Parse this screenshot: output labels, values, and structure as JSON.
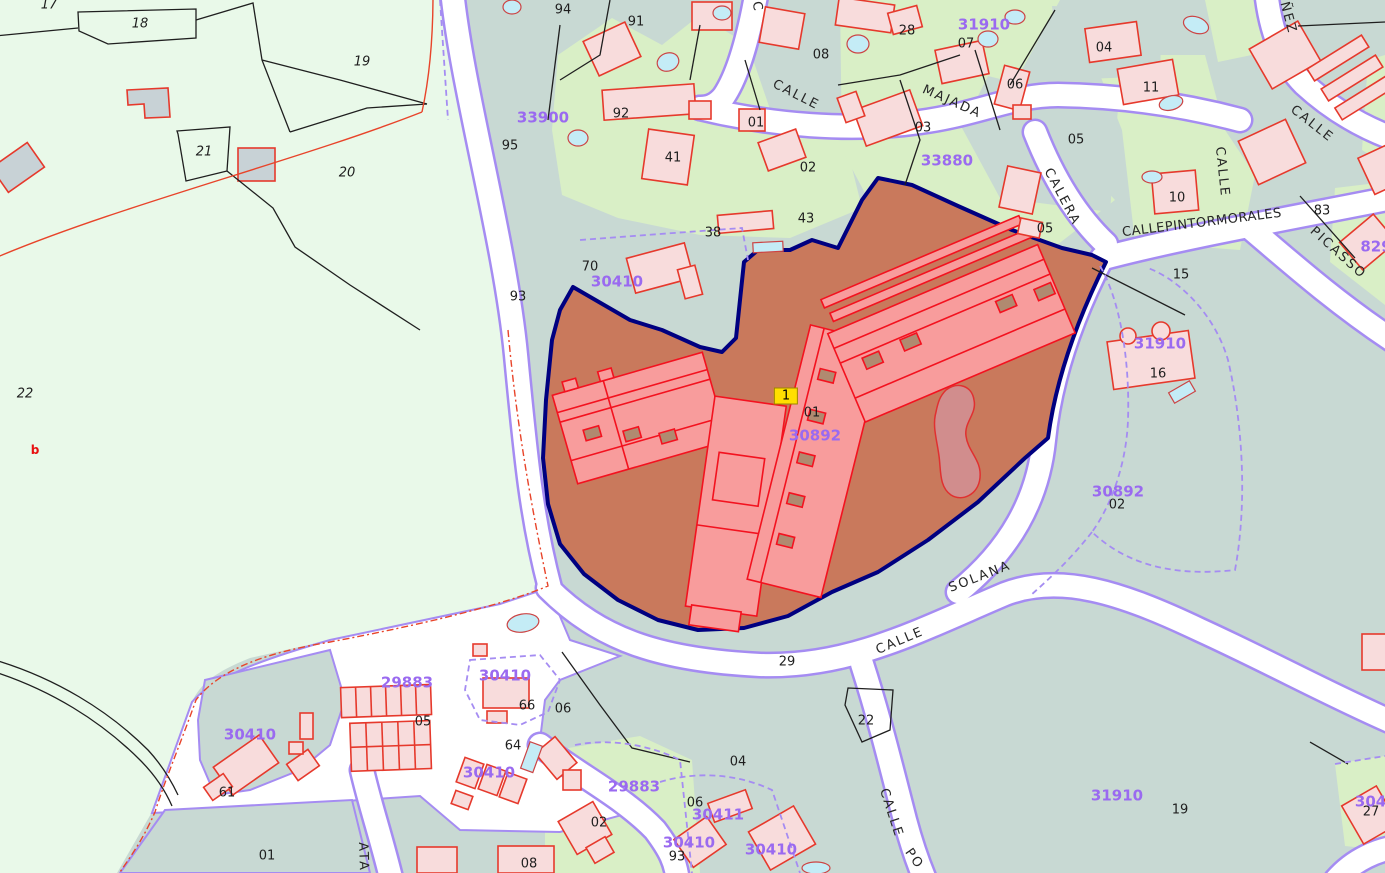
{
  "map_title": "Cadastral parcel map",
  "colors": {
    "rural_green": "#e9f9e9",
    "urban_grey_green": "#c8d9d3",
    "parcel_light_green": "#d9efc6",
    "road_fill": "#ffffff",
    "road_border": "#a58cf2",
    "highlight_parcel_fill": "#c9795c",
    "highlight_parcel_border": "#000080",
    "building_fill": "#f8dcdc",
    "building_stroke": "#e6392c",
    "selected_building_fill": "#f89c9c",
    "selected_building_stroke": "#f3121f",
    "patio_fill": "#b08a70",
    "pool_fill": "#c4ecf6",
    "pond_fill": "#d18d8d",
    "grey_building_fill": "#c8d2d6",
    "code_purple": "#9a6af0",
    "marker_yellow": "#ffdf00",
    "boundary_black": "#1f1f1f",
    "boundary_red": "#e8442a"
  },
  "selected_parcel": {
    "marker": "1",
    "code": "30892",
    "sub": "01"
  },
  "parcel_numbers": [
    "17",
    "18",
    "19",
    "21",
    "20",
    "22",
    "94",
    "91",
    "92",
    "95",
    "41",
    "01",
    "02",
    "08",
    "43",
    "38",
    "70",
    "93",
    "28",
    "07",
    "06",
    "04",
    "11",
    "03",
    "05",
    "05",
    "10",
    "15",
    "16",
    "83",
    "01",
    "02",
    "29",
    "22",
    "04",
    "05",
    "66",
    "06",
    "64",
    "61",
    "01",
    "06",
    "93",
    "02",
    "08",
    "19",
    "27"
  ],
  "red_marker": "b",
  "cadastral_codes": [
    "33900",
    "30410",
    "33880",
    "31910",
    "31910",
    "30892",
    "30892",
    "29883",
    "30410",
    "30410",
    "30410",
    "29883",
    "30411",
    "30410",
    "30410",
    "31910",
    "30411",
    "829"
  ],
  "street_names": [
    "CALLE",
    "MAJADA",
    "CALERA",
    "CALLEPINTORMORALES",
    "CALLE",
    "CALLE",
    "PICASSO",
    "ÑEZ",
    "CALLE",
    "SOLANA",
    "CALLE",
    "PO",
    "ATA",
    "C"
  ]
}
